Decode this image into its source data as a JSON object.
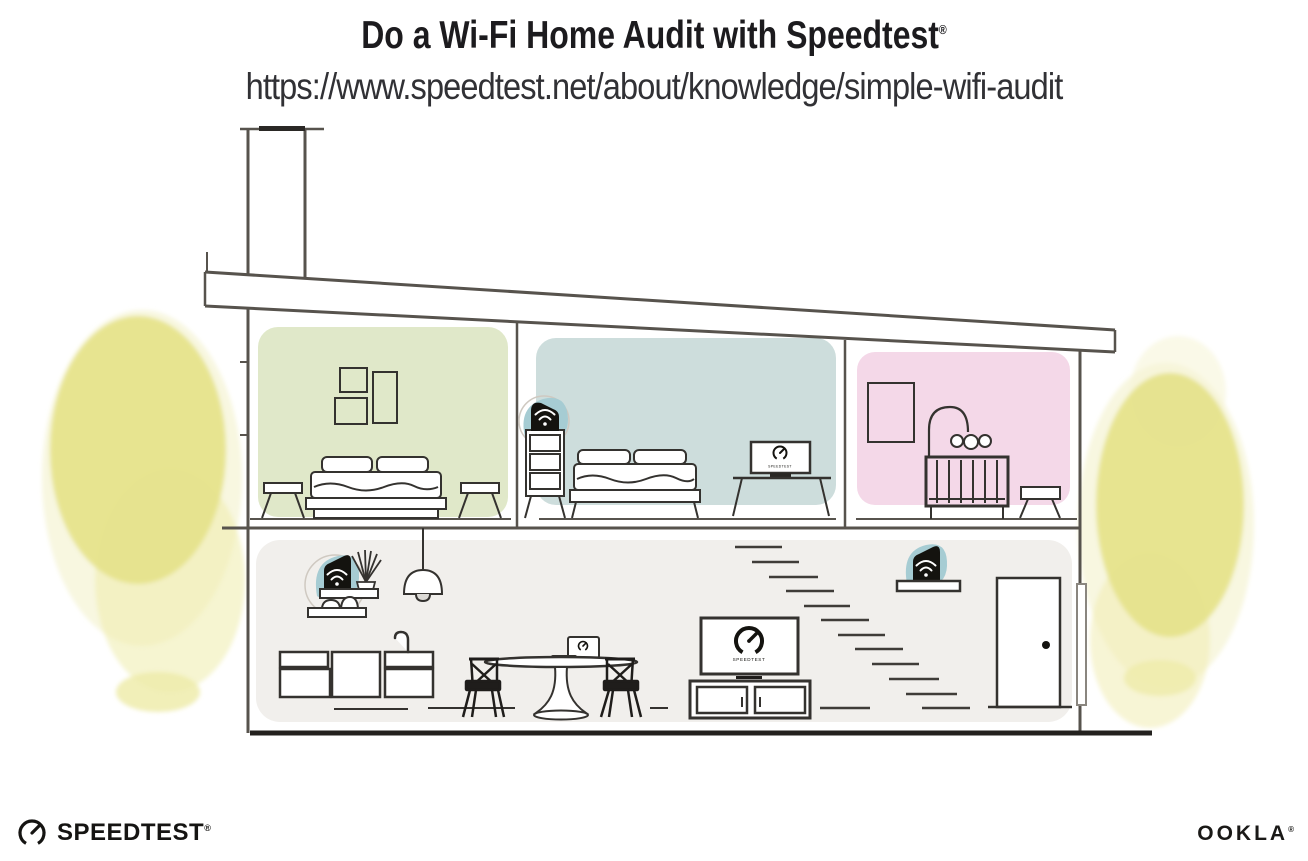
{
  "header": {
    "title": "Do a Wi-Fi Home Audit with Speedtest",
    "registered_mark": "®",
    "url": "https://www.speedtest.net/about/knowledge/simple-wifi-audit"
  },
  "illustration": {
    "screen_label": "SPEEDTEST",
    "icons": {
      "wifi_device": "wifi-signal-icon",
      "speed_gauge": "speedtest-gauge-icon"
    }
  },
  "footer": {
    "speedtest_wordmark": "SPEEDTEST",
    "speedtest_registered": "®",
    "ookla_wordmark": "OOKLA",
    "ookla_registered": "®"
  },
  "palette": {
    "line": "#57534d",
    "ink": "#1d1b19",
    "room_green": "#e0e8c9",
    "room_teal": "#cddddc",
    "room_pink": "#f4d8e8",
    "room_gray": "#f1efec",
    "device_teal": "#a6ccd3",
    "tree_main": "#e6e38c",
    "tree_light": "#efecab",
    "tree_pale": "#f6f4d6"
  }
}
